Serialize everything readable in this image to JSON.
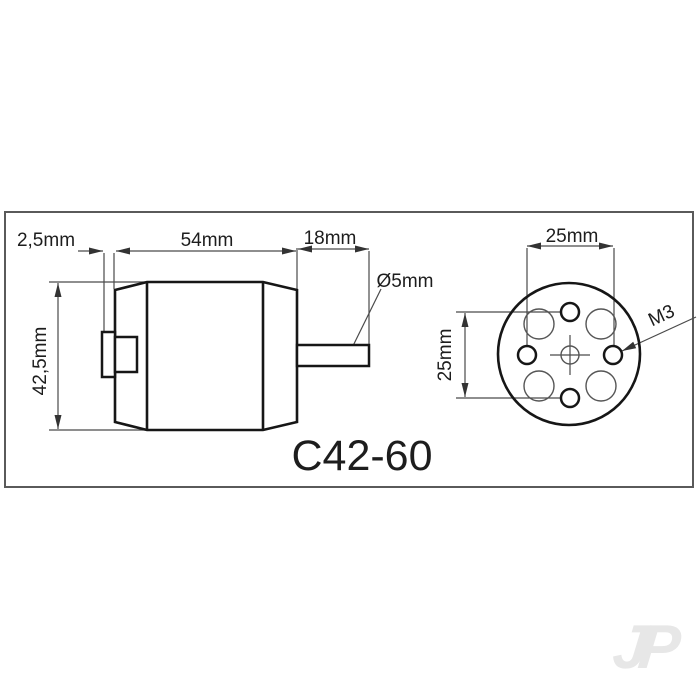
{
  "title": "C42-60",
  "side_view": {
    "dim_boss_offset": "2,5mm",
    "dim_body_length": "54mm",
    "dim_shaft_length": "18mm",
    "dim_shaft_diameter": "Ø5mm",
    "dim_body_height": "42,5mm"
  },
  "front_view": {
    "dim_hole_spacing_horizontal": "25mm",
    "dim_hole_spacing_vertical": "25mm",
    "thread_callout": "M3"
  },
  "watermark": "JP",
  "colors": {
    "background": "#ffffff",
    "outline": "#161616",
    "dimension_lines": "#4a4a4a",
    "frame": "#5a5a5a",
    "watermark": "#e7e7e7"
  }
}
